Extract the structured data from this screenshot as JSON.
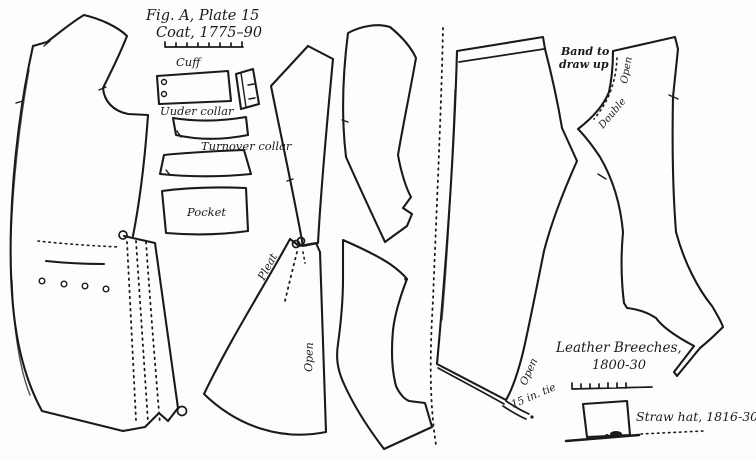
{
  "palette": {
    "paper": "#fdfdfb",
    "ink": "#1a1a1a"
  },
  "figure": {
    "title_line1": "Fig. A, Plate 15",
    "title_line2": "Coat, 1775–90"
  },
  "coat": {
    "labels": {
      "cuff": "Cuff",
      "under_collar": "Uuder collar",
      "turnover_collar": "Turnover collar",
      "pocket": "Pocket",
      "pleat": "Pleat",
      "open": "Open"
    }
  },
  "breeches": {
    "title_line1": "Leather Breeches,",
    "title_line2": "1800-30",
    "labels": {
      "band_line1": "Band to",
      "band_line2": "draw up",
      "open_waist": "Open",
      "double": "Double",
      "open_leg": "Open",
      "tie": "15 in. tie"
    }
  },
  "hat": {
    "label": "Straw hat, 1816-30"
  }
}
